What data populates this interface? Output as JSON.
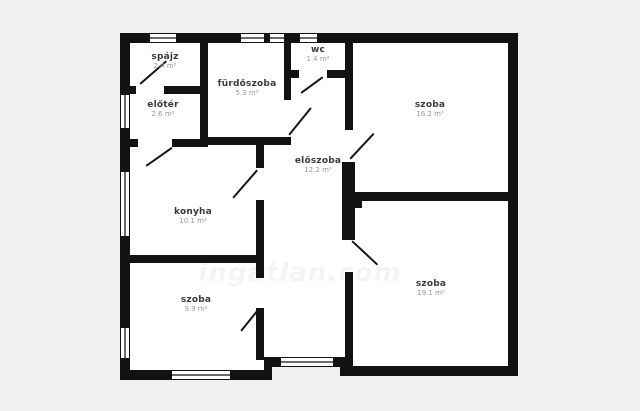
{
  "plan": {
    "type": "apartment-floor-plan",
    "watermark": "ingatlan.com",
    "colors": {
      "wall": "#121212",
      "floor": "#ffffff",
      "background": "#f1f0ee",
      "room_name_text": "#3b3b3b",
      "room_area_text": "#979797",
      "window_pane": "#6b6b6b"
    }
  },
  "rooms": [
    {
      "name": "spájz",
      "area": "2.4 m²"
    },
    {
      "name": "előtér",
      "area": "2.6 m²"
    },
    {
      "name": "fürdőszoba",
      "area": "5.3 m²"
    },
    {
      "name": "wc",
      "area": "1.4 m²"
    },
    {
      "name": "szoba",
      "area": "16.2 m²"
    },
    {
      "name": "előszoba",
      "area": "12.2 m²"
    },
    {
      "name": "konyha",
      "area": "10.1 m²"
    },
    {
      "name": "szoba",
      "area": "9.9 m²"
    },
    {
      "name": "szoba",
      "area": "19.1 m²"
    }
  ]
}
